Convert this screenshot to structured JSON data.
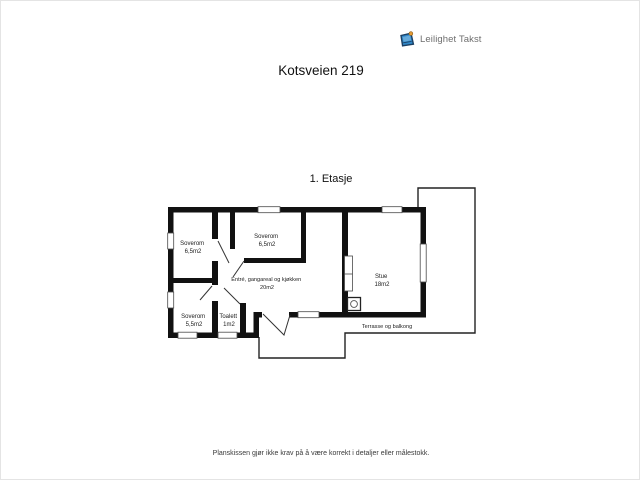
{
  "logo": {
    "text": "Leilighet Takst",
    "icon": "clipboard-icon",
    "icon_blue": "#2f86c6",
    "icon_dark": "#1b3f63",
    "icon_accent": "#e59b35",
    "text_color": "#6e6e6e"
  },
  "page": {
    "title": "Kotsveien 219",
    "floor_label": "1. Etasje",
    "disclaimer": "Planskissen gjør ikke krav på å være korrekt i detaljer eller målestokk."
  },
  "floorplan": {
    "wall_color": "#111111",
    "rooms": [
      {
        "name": "Soverom",
        "area": "6,5m2"
      },
      {
        "name": "Soverom",
        "area": "6,5m2"
      },
      {
        "name": "Entré, gangareal og kjøkken",
        "area": "20m2"
      },
      {
        "name": "Soverom",
        "area": "5,5m2"
      },
      {
        "name": "Toalett",
        "area": "1m2"
      },
      {
        "name": "Stue",
        "area": "18m2"
      }
    ],
    "outdoor_label": "Terrasse og balkong"
  }
}
